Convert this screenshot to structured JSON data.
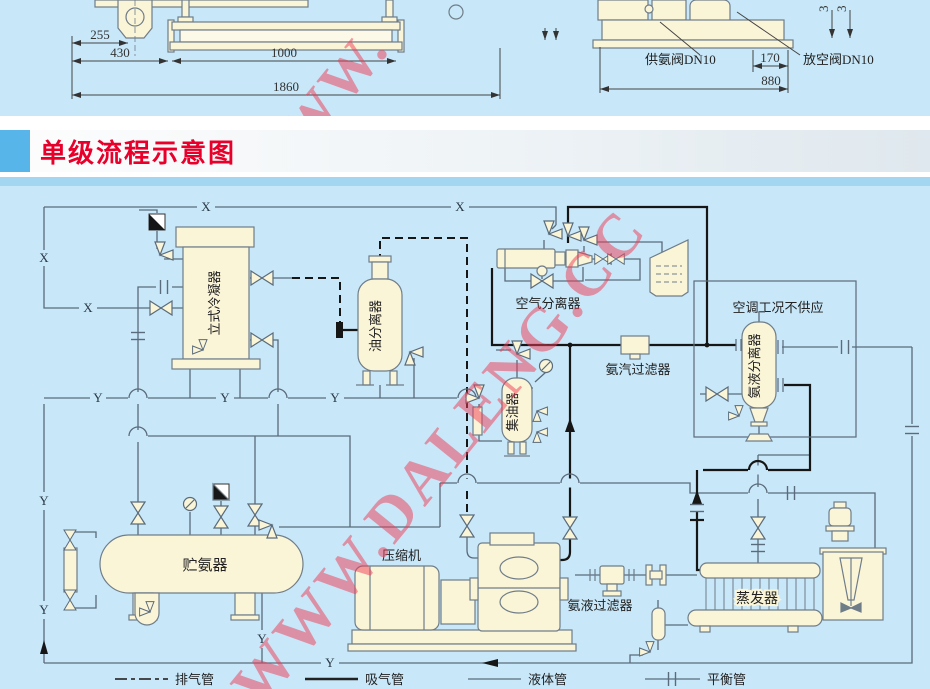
{
  "title": {
    "text": "单级流程示意图",
    "accent_color": "#e8002a"
  },
  "watermark": {
    "text": "WWW.DALENG.CC",
    "partial": "WWW.",
    "color": "#ee3c55"
  },
  "top_drawings": {
    "left": {
      "dims": [
        "255",
        "430",
        "1000",
        "1860"
      ]
    },
    "right": {
      "valve_labels": [
        "供氨阀DN10",
        "放空阀DN10"
      ],
      "dims": [
        "170",
        "880"
      ],
      "edge_partial_dims": [
        "3",
        "3"
      ]
    }
  },
  "diagram": {
    "markers": {
      "x": "X",
      "y": "Y"
    },
    "equipment": {
      "condenser": "立式冷凝器",
      "oil_separator": "油分离器",
      "air_separator": "空气分离器",
      "note_box": "空调工况不供应",
      "vapor_filter": "氨汽过滤器",
      "liquid_separator": "氨液分离器",
      "oil_collector": "集油器",
      "receiver": "贮氨器",
      "compressor": "压缩机",
      "liquid_filter": "氨液过滤器",
      "evaporator": "蒸发器"
    },
    "legend": [
      {
        "label": "排气管",
        "style": "dash-dot"
      },
      {
        "label": "吸气管",
        "style": "solid-thick"
      },
      {
        "label": "液体管",
        "style": "solid-thin"
      },
      {
        "label": "平衡管",
        "style": "union-line"
      }
    ],
    "colors": {
      "background": "#c8e7f8",
      "vessel_fill": "#fbf5d8",
      "pipe_gray": "#5a6b7b",
      "pipe_black": "#161616"
    }
  }
}
